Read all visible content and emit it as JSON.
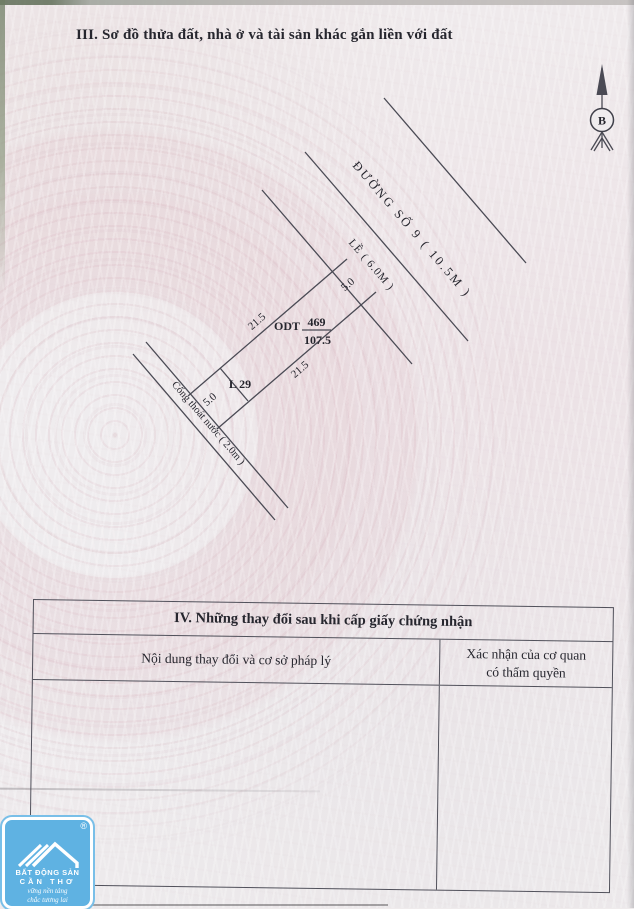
{
  "document": {
    "section_iii_title": "III. Sơ đồ thửa đất, nhà ở và tài sản khác gắn liền với đất"
  },
  "diagram": {
    "compass_north_label": "B",
    "road_label": "ĐƯỜNG SỐ 9 ( 10.5M )",
    "sidewalk_label": "LỀ ( 6.0M )",
    "drainage_label": "Cống thoát nước ( 2.0m )",
    "adjacent_lot_label": "L 29",
    "parcel": {
      "land_use_code": "ODT",
      "parcel_number": "469",
      "area_m2": "107.5",
      "dimensions": {
        "front": "5.0",
        "left_side": "21.5",
        "right_side": "21.5",
        "back": "5.0"
      }
    }
  },
  "changes_table": {
    "title": "IV. Những thay đổi sau khi cấp giấy chứng nhận",
    "col1_header": "Nội dung thay đổi và cơ sở pháp lý",
    "col2_header_line1": "Xác nhận của cơ quan",
    "col2_header_line2": "có thẩm quyền"
  },
  "watermark_logo": {
    "registered_mark": "®",
    "name_line1": "BẤT ĐỘNG SẢN",
    "name_line2": "CẦN THƠ",
    "slogan_line1": "vững nền tảng",
    "slogan_line2": "chắc tương lai",
    "background_color": "#5fb2e2"
  },
  "colors": {
    "paper": "#efebec",
    "ink": "#26262e",
    "line": "#4a4a54",
    "watermark_pink": "#d5a0ac"
  }
}
